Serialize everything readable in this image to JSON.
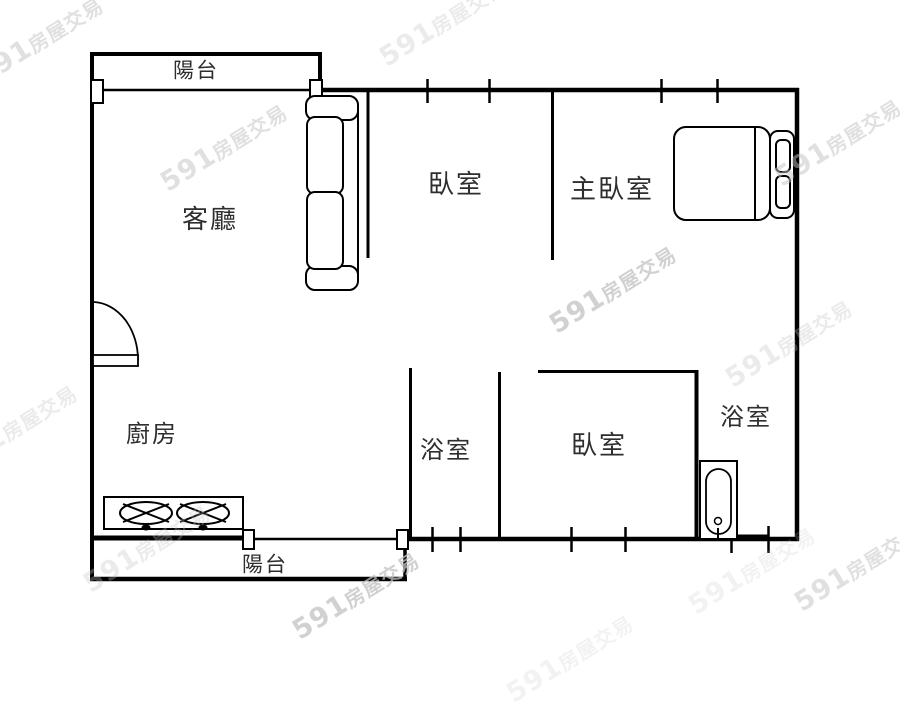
{
  "watermark": {
    "brand": "591",
    "suffix": "房屋交易"
  },
  "rooms": {
    "balcony_top": {
      "label": "陽台"
    },
    "living_room": {
      "label": "客廳"
    },
    "bedroom_top": {
      "label": "臥室"
    },
    "master_bedroom": {
      "label": "主臥室"
    },
    "kitchen": {
      "label": "廚房"
    },
    "bathroom_mid": {
      "label": "浴室"
    },
    "bedroom_lower": {
      "label": "臥室"
    },
    "bathroom_right": {
      "label": "浴室"
    },
    "balcony_bottom": {
      "label": "陽台"
    }
  },
  "furniture": [
    "sofa",
    "double-bed",
    "gas-stove",
    "bathtub",
    "entry-door"
  ],
  "colors": {
    "wall": "#000000",
    "background": "#ffffff",
    "watermark": "#c2c2c2"
  }
}
